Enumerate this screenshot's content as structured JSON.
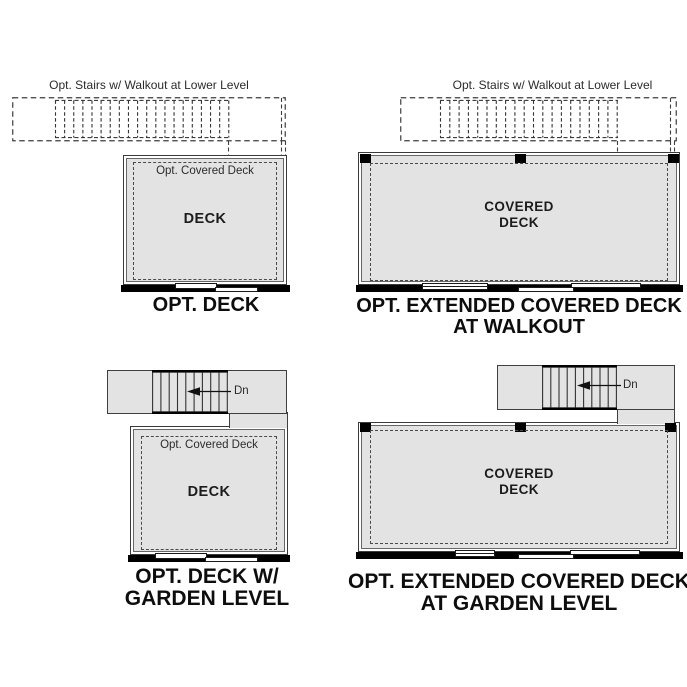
{
  "colors": {
    "deck_fill": "#e3e3e3",
    "wall": "#000000",
    "line": "#3d3d3d",
    "background": "#ffffff"
  },
  "figures": {
    "opt_deck": {
      "stairs_note": "Opt. Stairs w/ Walkout at Lower Level",
      "covered_note": "Opt. Covered Deck",
      "room": "DECK",
      "title": "OPT. DECK"
    },
    "extended_walkout": {
      "stairs_note": "Opt. Stairs w/ Walkout at Lower Level",
      "room_line1": "COVERED",
      "room_line2": "DECK",
      "title_line1": "OPT. EXTENDED COVERED DECK",
      "title_line2": "AT WALKOUT"
    },
    "deck_garden": {
      "down": "Dn",
      "covered_note": "Opt. Covered Deck",
      "room": "DECK",
      "title_line1": "OPT. DECK W/",
      "title_line2": "GARDEN LEVEL"
    },
    "extended_garden": {
      "down": "Dn",
      "room_line1": "COVERED",
      "room_line2": "DECK",
      "title_line1": "OPT. EXTENDED COVERED DECK",
      "title_line2": "AT GARDEN LEVEL"
    }
  }
}
